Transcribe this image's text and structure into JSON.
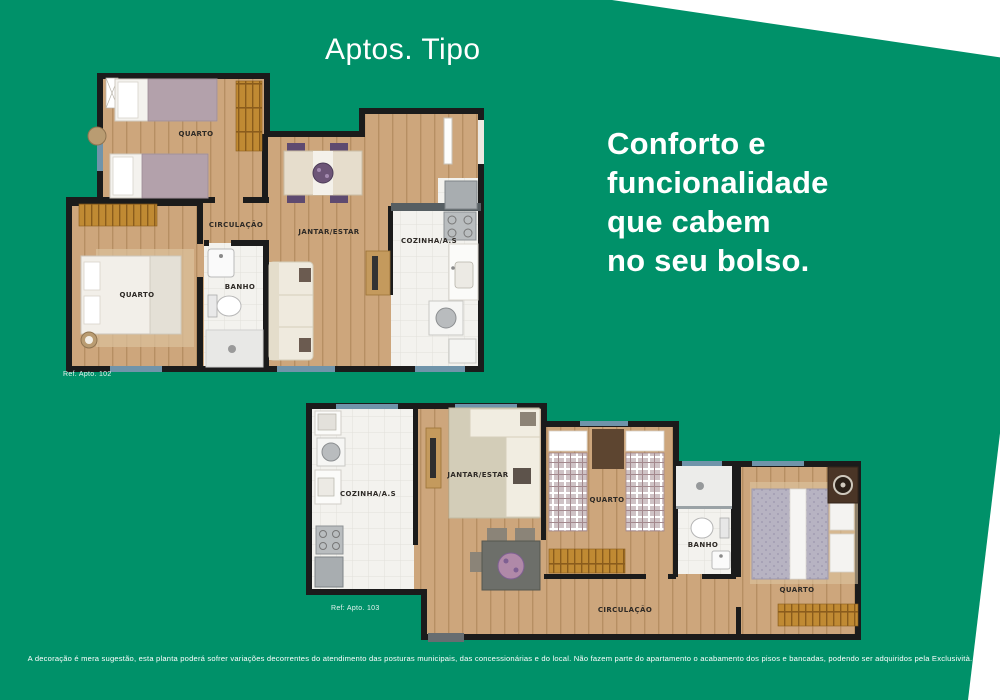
{
  "page": {
    "title": "Aptos. Tipo",
    "headline_lines": [
      "Conforto e",
      "funcionalidade",
      "que cabem",
      "no seu bolso."
    ],
    "disclaimer": "A decoração é mera sugestão, esta planta poderá sofrer variações decorrentes do atendimento das posturas municipais, das concessionárias e do local. Não fazem parte do apartamento o acabamento dos pisos e bancadas, podendo ser adquiridos pela Exclusività.",
    "background_color": "#009169"
  },
  "plan_102": {
    "ref": "Ref. Apto. 102",
    "labels": {
      "quarto_top": "QUARTO",
      "circulacao": "CIRCULAÇÃO",
      "jantar_estar": "JANTAR/ESTAR",
      "quarto_bottom": "QUARTO",
      "banho": "BANHO",
      "cozinha": "COZINHA/A.S"
    }
  },
  "plan_103": {
    "ref": "Ref: Apto. 103",
    "labels": {
      "cozinha": "COZINHA/A.S",
      "jantar_estar": "JANTAR/ESTAR",
      "quarto_middle": "QUARTO",
      "banho": "BANHO",
      "quarto_right": "QUARTO",
      "circulacao": "CIRCULAÇÃO"
    }
  },
  "colors": {
    "wall": "#1b1b1b",
    "wood_floor": "#cda67c",
    "tile_floor": "#f3f2ee",
    "window": "#7094aa",
    "wardrobe": "#c08a33",
    "accent_purple": "#5e4a70"
  }
}
